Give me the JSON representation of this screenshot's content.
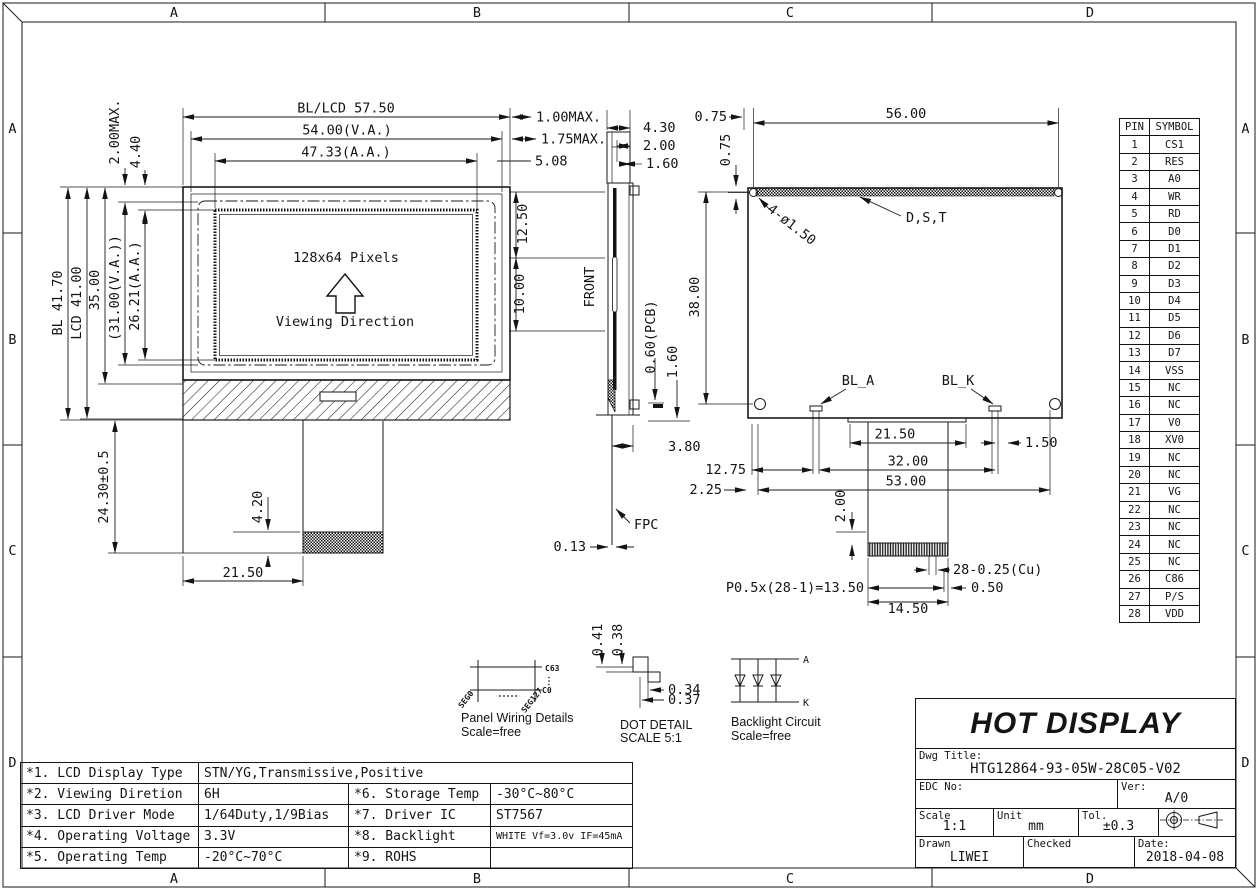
{
  "frame": {
    "top": [
      "A",
      "B",
      "C",
      "D"
    ],
    "bottom": [
      "A",
      "B",
      "C",
      "D"
    ],
    "left": [
      "A",
      "B",
      "C",
      "D"
    ],
    "right": [
      "A",
      "B",
      "C",
      "D"
    ]
  },
  "front_view": {
    "dim_top1": "BL/LCD 57.50",
    "dim_top2": "54.00(V.A.)",
    "dim_top3": "47.33(A.A.)",
    "rot_2max": "2.00MAX.",
    "rot_440": "4.40",
    "rot_bl": "BL 41.70",
    "rot_lcd": "LCD 41.00",
    "rot_35": "35.00",
    "rot_31": "(31.00(V.A.))",
    "rot_2621": "26.21(A.A.)",
    "pixels": "128x64 Pixels",
    "viewing": "Viewing Direction",
    "rot_2430": "24.30±0.5",
    "rot_420": "4.20",
    "dim_2150": "21.50",
    "dim_1max": "1.00MAX.",
    "dim_175max": "1.75MAX.",
    "dim_508": "5.08"
  },
  "side_view": {
    "label_front": "FRONT",
    "dim_430": "4.30",
    "dim_200": "2.00",
    "dim_160": "1.60",
    "rot_1250": "12.50",
    "rot_1000": "10.00",
    "rot_060pcb": "0.60(PCB)",
    "rot_160": "1.60",
    "dim_380": "3.80",
    "dim_013": "0.13",
    "label_fpc": "FPC"
  },
  "back_view": {
    "dim_075h": "0.75",
    "rot_075": "0.75",
    "dim_5600": "56.00",
    "label_holes": "4-ø1.50",
    "label_dst": "D,S,T",
    "rot_3800": "38.00",
    "label_bla": "BL_A",
    "label_blk": "BL_K",
    "dim_2150": "21.50",
    "dim_150": "1.50",
    "dim_1275": "12.75",
    "dim_3200": "32.00",
    "dim_225": "2.25",
    "dim_5300": "53.00",
    "rot_200": "2.00",
    "dim_pitch": "P0.5x(28-1)=13.50",
    "dim_1450": "14.50",
    "dim_cu": "28-0.25(Cu)",
    "dim_050": "0.50"
  },
  "details": {
    "panel": {
      "title": "Panel Wiring Details",
      "scale": "Scale=free",
      "c63": "C63",
      "c0": "C0",
      "seg0": "SEG0",
      "seg127": "SEG127"
    },
    "dot": {
      "title": "DOT DETAIL",
      "scale": "SCALE 5:1",
      "d041": "0.41",
      "d038": "0.38",
      "d034": "0.34",
      "d037": "0.37"
    },
    "backlight": {
      "title": "Backlight Circuit",
      "scale": "Scale=free",
      "anode": "A",
      "cathode": "K"
    }
  },
  "pin_table": {
    "headers": {
      "pin": "PIN",
      "symbol": "SYMBOL"
    },
    "rows": [
      {
        "pin": "1",
        "symbol": "CS1"
      },
      {
        "pin": "2",
        "symbol": "RES"
      },
      {
        "pin": "3",
        "symbol": "A0"
      },
      {
        "pin": "4",
        "symbol": "WR"
      },
      {
        "pin": "5",
        "symbol": "RD"
      },
      {
        "pin": "6",
        "symbol": "D0"
      },
      {
        "pin": "7",
        "symbol": "D1"
      },
      {
        "pin": "8",
        "symbol": "D2"
      },
      {
        "pin": "9",
        "symbol": "D3"
      },
      {
        "pin": "10",
        "symbol": "D4"
      },
      {
        "pin": "11",
        "symbol": "D5"
      },
      {
        "pin": "12",
        "symbol": "D6"
      },
      {
        "pin": "13",
        "symbol": "D7"
      },
      {
        "pin": "14",
        "symbol": "VSS"
      },
      {
        "pin": "15",
        "symbol": "NC"
      },
      {
        "pin": "16",
        "symbol": "NC"
      },
      {
        "pin": "17",
        "symbol": "V0"
      },
      {
        "pin": "18",
        "symbol": "XV0"
      },
      {
        "pin": "19",
        "symbol": "NC"
      },
      {
        "pin": "20",
        "symbol": "NC"
      },
      {
        "pin": "21",
        "symbol": "VG"
      },
      {
        "pin": "22",
        "symbol": "NC"
      },
      {
        "pin": "23",
        "symbol": "NC"
      },
      {
        "pin": "24",
        "symbol": "NC"
      },
      {
        "pin": "25",
        "symbol": "NC"
      },
      {
        "pin": "26",
        "symbol": "C86"
      },
      {
        "pin": "27",
        "symbol": "P/S"
      },
      {
        "pin": "28",
        "symbol": "VDD"
      }
    ]
  },
  "spec_table": {
    "rows": {
      "r1": {
        "k1": "*1. LCD Display Type",
        "v1": "STN/YG,Transmissive,Positive"
      },
      "r2": {
        "k1": "*2. Viewing Diretion",
        "v1": "6H",
        "k2": "*6. Storage Temp",
        "v2": "-30°C~80°C"
      },
      "r3": {
        "k1": "*3. LCD Driver Mode",
        "v1": "1/64Duty,1/9Bias",
        "k2": "*7. Driver IC",
        "v2": "ST7567"
      },
      "r4": {
        "k1": "*4. Operating Voltage",
        "v1": "3.3V",
        "k2": "*8. Backlight",
        "v2": "WHITE Vf=3.0v IF=45mA"
      },
      "r5": {
        "k1": "*5. Operating Temp",
        "v1": "-20°C~70°C",
        "k2": "*9. ROHS",
        "v2": ""
      }
    }
  },
  "title_block": {
    "brand": "HOT DISPLAY",
    "dwg_label": "Dwg Title:",
    "dwg_no": "HTG12864-93-05W-28C05-V02",
    "edc_label": "EDC No:",
    "ver_label": "Ver:",
    "ver": "A/0",
    "scale_label": "Scale",
    "scale": "1:1",
    "unit_label": "Unit",
    "unit": "mm",
    "tol_label": "Tol.",
    "tol": "±0.3",
    "drawn_label": "Drawn",
    "drawn": "LIWEI",
    "checked_label": "Checked",
    "checked": "",
    "date_label": "Date:",
    "date": "2018-04-08"
  }
}
